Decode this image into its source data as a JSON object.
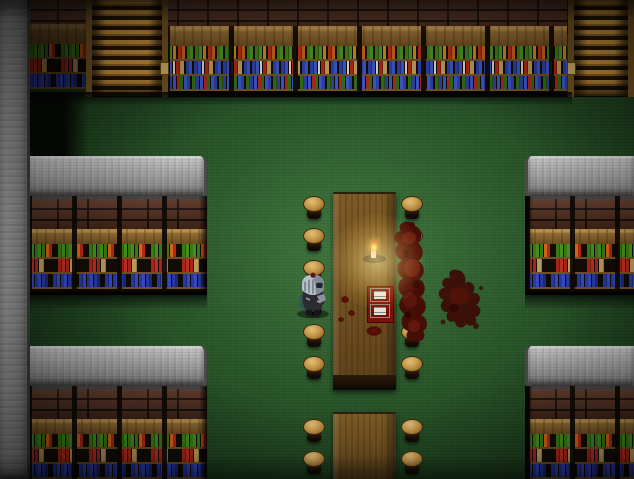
{
  "scene": {
    "title": "Top-down RPG interior: dark tavern library with bookshelves, long tables, a knight and a slain red creature by candlelight",
    "floor": {
      "type": "green carpet",
      "color": "#2a5628"
    },
    "structures": {
      "left_stone_column": {
        "x": 0,
        "y": 0,
        "w": 27,
        "h": 479
      },
      "top_brick_wall": {
        "x": 27,
        "y": 0,
        "w": 545,
        "h": 34
      },
      "top_shelves": {
        "x": 165,
        "y": 26,
        "w": 402,
        "h": 70
      },
      "small_shelf_top_left": {
        "x": 30,
        "y": 24,
        "w": 56,
        "h": 68
      },
      "stairs_top_left": {
        "x": 86,
        "y": 0,
        "w": 82,
        "h": 97
      },
      "stairs_top_right": {
        "x": 568,
        "y": 0,
        "w": 66,
        "h": 97
      },
      "block_left_mid": {
        "x": 27,
        "y": 156,
        "w": 180,
        "h": 136
      },
      "block_bottom_left": {
        "x": 27,
        "y": 346,
        "w": 180,
        "h": 136
      },
      "block_right_mid": {
        "x": 525,
        "y": 156,
        "w": 109,
        "h": 136
      },
      "block_bottom_right": {
        "x": 525,
        "y": 346,
        "w": 109,
        "h": 136
      },
      "wall_shadow": {
        "x": 27,
        "y": 92,
        "w": 545,
        "h": 14
      },
      "dark_zone_left": {
        "x": 27,
        "y": 92,
        "w": 62,
        "h": 66
      }
    },
    "tables": [
      {
        "id": "long-table-center",
        "x": 333,
        "y": 192,
        "w": 63,
        "h": 198
      },
      {
        "id": "long-table-bottom",
        "x": 333,
        "y": 412,
        "w": 63,
        "h": 67
      }
    ],
    "stools": [
      {
        "x": 303,
        "y": 196
      },
      {
        "x": 303,
        "y": 228
      },
      {
        "x": 303,
        "y": 260
      },
      {
        "x": 303,
        "y": 292
      },
      {
        "x": 303,
        "y": 324
      },
      {
        "x": 303,
        "y": 356
      },
      {
        "x": 401,
        "y": 196
      },
      {
        "x": 401,
        "y": 228
      },
      {
        "x": 401,
        "y": 260
      },
      {
        "x": 401,
        "y": 292
      },
      {
        "x": 401,
        "y": 324
      },
      {
        "x": 401,
        "y": 356
      },
      {
        "x": 303,
        "y": 419
      },
      {
        "x": 303,
        "y": 451
      },
      {
        "x": 401,
        "y": 419
      },
      {
        "x": 401,
        "y": 451
      }
    ],
    "entities": {
      "knight": {
        "label": "armored knight",
        "x": 293,
        "y": 272,
        "w": 40,
        "h": 46,
        "facing": "right"
      },
      "red_creature": {
        "label": "slain red creature",
        "x": 388,
        "y": 220,
        "w": 46,
        "h": 124
      },
      "blood_splatter": {
        "label": "blood splatter",
        "x": 429,
        "y": 266,
        "w": 60,
        "h": 74
      }
    },
    "props": {
      "candle": {
        "label": "lit candle on holder",
        "x": 363,
        "y": 243
      },
      "candle_glow": {
        "x": 330,
        "y": 214,
        "w": 95,
        "h": 95
      },
      "open_book": {
        "label": "open book with red cover",
        "x": 367,
        "y": 286
      }
    },
    "blood_spots": [
      {
        "x": 366,
        "y": 326,
        "w": 16,
        "h": 10
      },
      {
        "x": 341,
        "y": 296,
        "w": 8,
        "h": 7
      },
      {
        "x": 348,
        "y": 310,
        "w": 7,
        "h": 6
      },
      {
        "x": 338,
        "y": 317,
        "w": 6,
        "h": 5
      }
    ]
  },
  "palette": {
    "carpet_green": "#2a5628",
    "stone_gray": "#9c9c9c",
    "brick_red_brown": "#55301f",
    "shelf_wood": "#8f6a33",
    "stair_wood": "#c08c3a",
    "table_brown": "#6e4f20",
    "stool_tan": "#c89c50",
    "book_red": "#a82418",
    "book_green": "#3a7a16",
    "book_blue": "#2838a0",
    "blood_red": "#4a0c05",
    "candle_glow": "#ffe491",
    "knight_silver": "#b9bfc8"
  }
}
